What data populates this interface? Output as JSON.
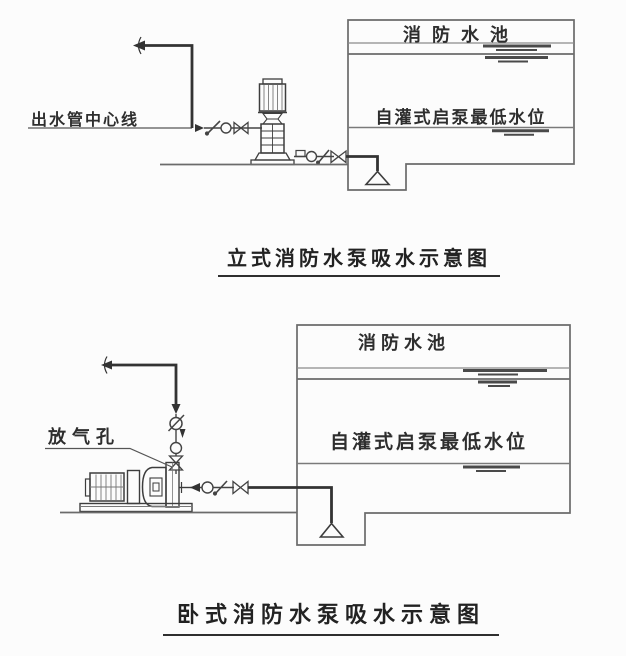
{
  "page": {
    "background_color": "#fcfcfc",
    "line_color": "#555555",
    "pipe_color": "#333333",
    "text_color": "#2e2e2e"
  },
  "top_diagram": {
    "caption": "立式消防水泵吸水示意图",
    "outlet_centerline_label": "出水管中心线",
    "tank": {
      "title": "消防水池",
      "low_level_label": "自灌式启泵最低水位"
    }
  },
  "bottom_diagram": {
    "caption": "卧式消防水泵吸水示意图",
    "air_vent_label": "放气孔",
    "tank": {
      "title": "消防水池",
      "low_level_label": "自灌式启泵最低水位"
    }
  }
}
